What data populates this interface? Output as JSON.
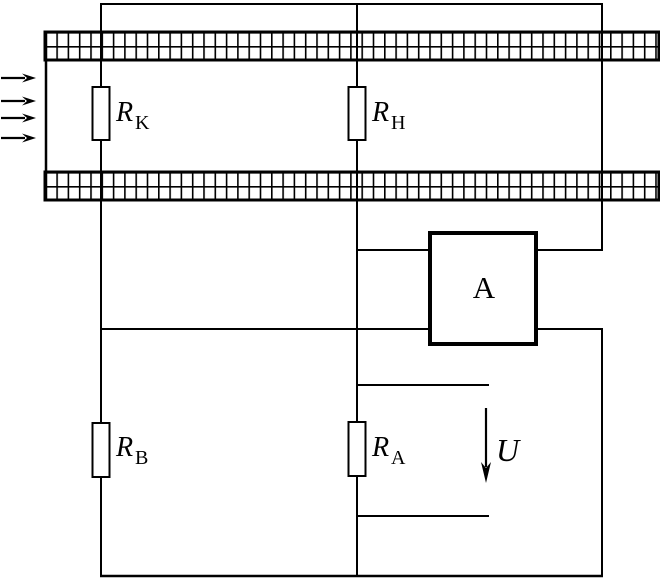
{
  "diagram": {
    "labels": {
      "rk": {
        "base": "R",
        "sub": "K"
      },
      "rh": {
        "base": "R",
        "sub": "H"
      },
      "rb": {
        "base": "R",
        "sub": "B"
      },
      "ra": {
        "base": "R",
        "sub": "A"
      },
      "amplifier": "A",
      "voltage": "U"
    },
    "icons": {
      "airflow": {
        "name": "flow-arrow-icon",
        "direction": "right",
        "count": 4
      },
      "voltage_arrow": {
        "name": "down-arrow-icon",
        "direction": "down"
      }
    },
    "colors": {
      "ink": "#000000",
      "paper": "#ffffff"
    }
  }
}
